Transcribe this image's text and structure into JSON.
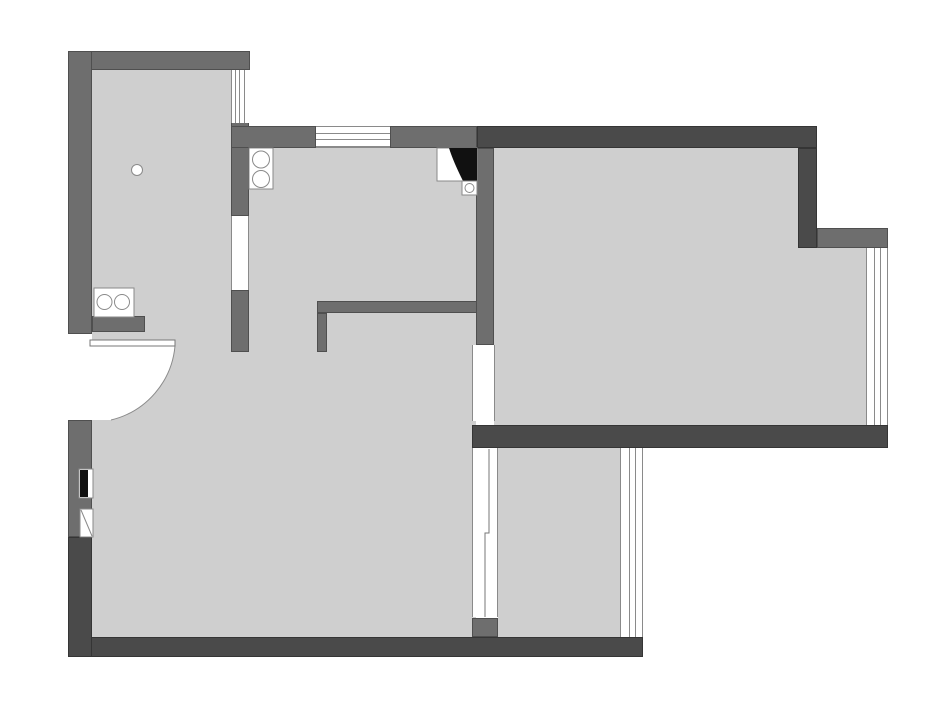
{
  "canvas": {
    "width": 940,
    "height": 708,
    "background": "#ffffff"
  },
  "palette": {
    "floor": "#cfcfcf",
    "wall_medium": "#6e6e6e",
    "wall_dark": "#4a4a4a",
    "thin_line": "#8a8a8a",
    "fixture_stroke": "#8a8a8a",
    "black": "#111111",
    "white": "#ffffff"
  },
  "floors": [
    {
      "name": "floor-left-wing",
      "x": 92,
      "y": 70,
      "w": 139,
      "h": 567
    },
    {
      "name": "floor-kitchen-hall",
      "x": 231,
      "y": 148,
      "w": 245,
      "h": 489
    },
    {
      "name": "floor-living-room",
      "x": 494,
      "y": 148,
      "w": 304,
      "h": 277
    },
    {
      "name": "floor-living-extension",
      "x": 798,
      "y": 248,
      "w": 68,
      "h": 177
    },
    {
      "name": "floor-bottom-room",
      "x": 498,
      "y": 448,
      "w": 122,
      "h": 189
    }
  ],
  "walls": [
    {
      "name": "wall-top-left",
      "x": 68,
      "y": 51,
      "w": 182,
      "h": 19,
      "tone": "medium"
    },
    {
      "name": "wall-left-upper",
      "x": 68,
      "y": 51,
      "w": 24,
      "h": 283,
      "tone": "medium"
    },
    {
      "name": "wall-left-mid",
      "x": 68,
      "y": 420,
      "w": 24,
      "h": 117,
      "tone": "medium"
    },
    {
      "name": "wall-entry-stub",
      "x": 92,
      "y": 316,
      "w": 53,
      "h": 16,
      "tone": "medium"
    },
    {
      "name": "wall-divider-upper",
      "x": 231,
      "y": 122,
      "w": 18,
      "h": 94,
      "tone": "medium"
    },
    {
      "name": "wall-divider-lower",
      "x": 231,
      "y": 290,
      "w": 18,
      "h": 62,
      "tone": "medium"
    },
    {
      "name": "wall-kitchen-top-left",
      "x": 231,
      "y": 126,
      "w": 85,
      "h": 22,
      "tone": "medium"
    },
    {
      "name": "wall-kitchen-top-right",
      "x": 390,
      "y": 126,
      "w": 87,
      "h": 22,
      "tone": "medium"
    },
    {
      "name": "wall-living-left",
      "x": 476,
      "y": 148,
      "w": 18,
      "h": 197,
      "tone": "medium"
    },
    {
      "name": "wall-interior-L",
      "x": 317,
      "y": 301,
      "w": 160,
      "h": 12,
      "tone": "medium"
    },
    {
      "name": "wall-interior-L-leg",
      "x": 317,
      "y": 313,
      "w": 10,
      "h": 39,
      "tone": "medium"
    },
    {
      "name": "wall-notch-right",
      "x": 817,
      "y": 228,
      "w": 71,
      "h": 20,
      "tone": "medium"
    },
    {
      "name": "wall-partition-stub",
      "x": 472,
      "y": 618,
      "w": 26,
      "h": 19,
      "tone": "medium"
    },
    {
      "name": "wall-top-right",
      "x": 477,
      "y": 126,
      "w": 340,
      "h": 22,
      "tone": "dark"
    },
    {
      "name": "wall-living-right-vert",
      "x": 798,
      "y": 148,
      "w": 19,
      "h": 100,
      "tone": "dark"
    },
    {
      "name": "wall-living-bottom",
      "x": 472,
      "y": 425,
      "w": 416,
      "h": 23,
      "tone": "dark"
    },
    {
      "name": "wall-plan-bottom",
      "x": 68,
      "y": 637,
      "w": 575,
      "h": 20,
      "tone": "dark"
    },
    {
      "name": "wall-left-lower",
      "x": 68,
      "y": 537,
      "w": 24,
      "h": 120,
      "tone": "dark"
    }
  ],
  "openings": [
    {
      "name": "opening-entrance-door",
      "x": 68,
      "y": 334,
      "w": 24,
      "h": 86,
      "edges": []
    },
    {
      "name": "opening-divider-gap",
      "x": 231,
      "y": 216,
      "w": 18,
      "h": 74,
      "edges": [
        "l",
        "r"
      ]
    },
    {
      "name": "opening-living-door",
      "x": 472,
      "y": 345,
      "w": 23,
      "h": 76,
      "edges": [
        "l",
        "r"
      ]
    },
    {
      "name": "opening-glazed-partition",
      "x": 472,
      "y": 448,
      "w": 26,
      "h": 169,
      "edges": [
        "l",
        "r"
      ]
    }
  ],
  "windows": [
    {
      "name": "window-left-room",
      "x": 231,
      "y": 70,
      "w": 19,
      "h": 53,
      "dir": "v",
      "lines": [
        233.5,
        238,
        242.5
      ],
      "edges": [
        "l"
      ]
    },
    {
      "name": "window-kitchen-top",
      "x": 316,
      "y": 126,
      "w": 74,
      "h": 22,
      "dir": "h",
      "lines": [
        131.5,
        138,
        144.5
      ],
      "edges": [
        "t",
        "b"
      ]
    },
    {
      "name": "window-living-right",
      "x": 866,
      "y": 248,
      "w": 22,
      "h": 177,
      "dir": "v",
      "lines": [
        872.5,
        879
      ],
      "edges": [
        "l",
        "r"
      ]
    },
    {
      "name": "window-bottom-room",
      "x": 620,
      "y": 448,
      "w": 23,
      "h": 189,
      "dir": "v",
      "lines": [
        627.5,
        634
      ],
      "edges": [
        "l",
        "r"
      ]
    }
  ],
  "fixtures": [
    {
      "name": "door-swing-area-icon",
      "type": "path",
      "d": "M 92 346 L 175 346 A 84 84 0 0 1 111 420 L 92 420 Z",
      "fill": "#ffffff",
      "stroke": "none"
    },
    {
      "name": "door-swing-arc-icon",
      "type": "path",
      "d": "M 175 346 A 84 84 0 0 1 111 420",
      "fill": "none",
      "stroke": "#8a8a8a"
    },
    {
      "name": "door-leaf-icon",
      "type": "rect",
      "x": 90,
      "y": 340,
      "w": 85,
      "h": 6,
      "fill": "#ffffff",
      "stroke": "#777777"
    },
    {
      "name": "ceiling-light-icon",
      "type": "circle",
      "cx": 137,
      "cy": 170,
      "r": 5.5,
      "fill": "#ffffff",
      "stroke": "#8a8a8a"
    },
    {
      "name": "stove-box-icon",
      "type": "rect",
      "x": 249,
      "y": 148,
      "w": 24,
      "h": 41,
      "fill": "#ffffff",
      "stroke": "#8a8a8a"
    },
    {
      "name": "stove-burner-top-icon",
      "type": "circle",
      "cx": 261,
      "cy": 159.5,
      "r": 8.5,
      "fill": "#ffffff",
      "stroke": "#8a8a8a"
    },
    {
      "name": "stove-burner-bottom-icon",
      "type": "circle",
      "cx": 261,
      "cy": 179,
      "r": 8.5,
      "fill": "#ffffff",
      "stroke": "#8a8a8a"
    },
    {
      "name": "hob-box-icon",
      "type": "rect",
      "x": 94,
      "y": 288,
      "w": 40,
      "h": 29,
      "fill": "#ffffff",
      "stroke": "#8a8a8a"
    },
    {
      "name": "hob-burner-left-icon",
      "type": "circle",
      "cx": 104.5,
      "cy": 302,
      "r": 7.5,
      "fill": "#ffffff",
      "stroke": "#8a8a8a"
    },
    {
      "name": "hob-burner-right-icon",
      "type": "circle",
      "cx": 122,
      "cy": 302,
      "r": 7.5,
      "fill": "#ffffff",
      "stroke": "#8a8a8a"
    },
    {
      "name": "vent-shaft-box-icon",
      "type": "rect",
      "x": 437,
      "y": 148,
      "w": 40,
      "h": 33,
      "fill": "#ffffff",
      "stroke": "#8a8a8a"
    },
    {
      "name": "vent-flue-icon",
      "type": "path",
      "d": "M 449 148 L 477 148 L 477 181 L 463 181 Q 453 161 449 148 Z",
      "fill": "#111111",
      "stroke": "none"
    },
    {
      "name": "sink-box-icon",
      "type": "rect",
      "x": 462,
      "y": 181,
      "w": 15,
      "h": 14,
      "fill": "#ffffff",
      "stroke": "#8a8a8a"
    },
    {
      "name": "sink-bowl-icon",
      "type": "circle",
      "cx": 469.5,
      "cy": 188,
      "r": 4.5,
      "fill": "#ffffff",
      "stroke": "#8a8a8a"
    },
    {
      "name": "electric-panel-box-icon",
      "type": "rect",
      "x": 79,
      "y": 469,
      "w": 14,
      "h": 29,
      "fill": "#ffffff",
      "stroke": "#8a8a8a"
    },
    {
      "name": "electric-panel-icon",
      "type": "rect",
      "x": 80,
      "y": 470,
      "w": 8,
      "h": 27,
      "fill": "#111111",
      "stroke": "none"
    },
    {
      "name": "duct-box-icon",
      "type": "rect",
      "x": 80,
      "y": 509,
      "w": 13,
      "h": 28,
      "fill": "#ffffff",
      "stroke": "#8a8a8a"
    },
    {
      "name": "duct-diagonal-icon",
      "type": "line",
      "x1": 81,
      "y1": 510,
      "x2": 92,
      "y2": 536,
      "fill": "none",
      "stroke": "#8a8a8a"
    },
    {
      "name": "sliding-door-line-icon",
      "type": "polyline",
      "points": "489,449 489,533 485,533 485,617",
      "fill": "none",
      "stroke": "#777777"
    }
  ]
}
